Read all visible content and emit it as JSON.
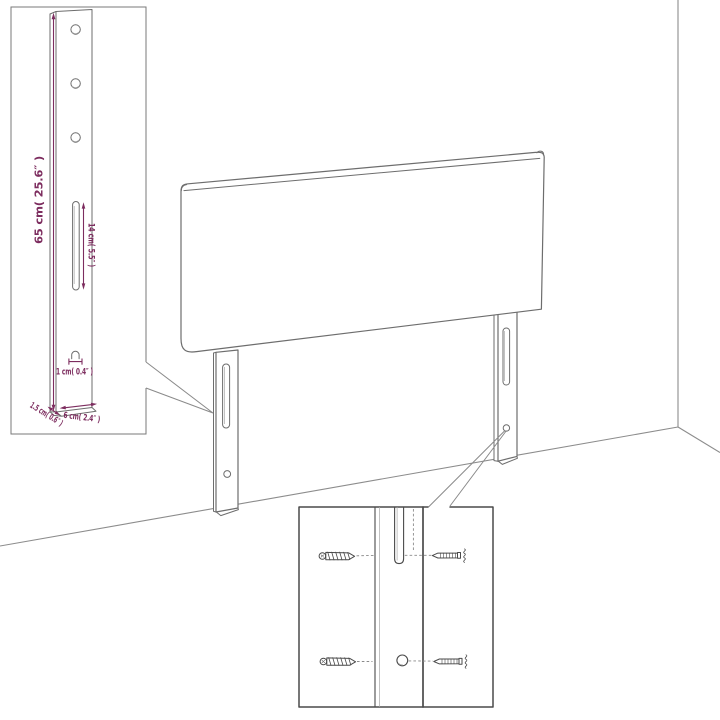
{
  "canvas": {
    "width": 720,
    "height": 720,
    "background": "#ffffff"
  },
  "palette": {
    "artwork_line": "#6d6d6d",
    "wall_line": "#8c8c8c",
    "hardware_line": "#4a4a4a",
    "dimension_color": "#7d2d5f"
  },
  "diagram": {
    "kind": "headboard-assembly-dimension-diagram",
    "subject": "upholstered headboard with two slotted mounting legs shown in a room corner",
    "leg_detail": {
      "height_label": "65 cm( 25.6″ )",
      "slot_label": "14 cm( 5.5″ )",
      "hole_label": "1 cm( 0.4″ )",
      "depth_label": "1.5 cm( 0.6″ )",
      "width_label": "6 cm( 2.4″ )"
    }
  }
}
